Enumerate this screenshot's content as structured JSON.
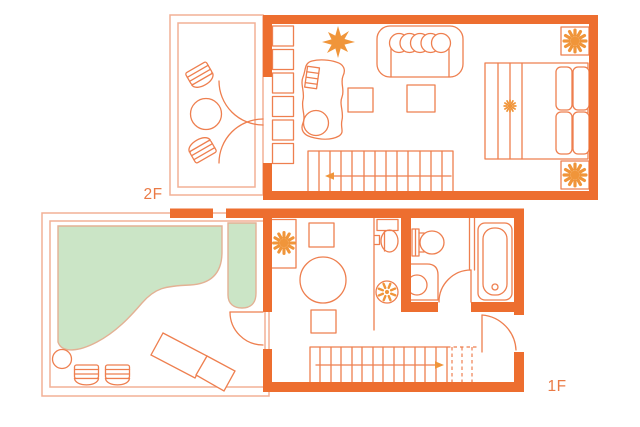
{
  "floor_labels": {
    "upper": "2F",
    "lower": "1F"
  },
  "colors": {
    "wall": "#ed6e2f",
    "furniture_line": "#ee7f4f",
    "thin_border": "#f2b095",
    "lawn_fill": "#cbe5c6",
    "lawn_outline": "#e3b194",
    "accent_fill": "#f0953a",
    "label_text": "#ea7a45",
    "background": "#ffffff"
  },
  "icons": {
    "starburst": "spiky-star-decor",
    "potted_plant": "radial-sun-plant",
    "bed_flower": "small-radial-flower",
    "washing_machine": "drum-circle",
    "stairs_direction_2f": "arrow-left",
    "stairs_direction_1f": "arrow-right"
  }
}
